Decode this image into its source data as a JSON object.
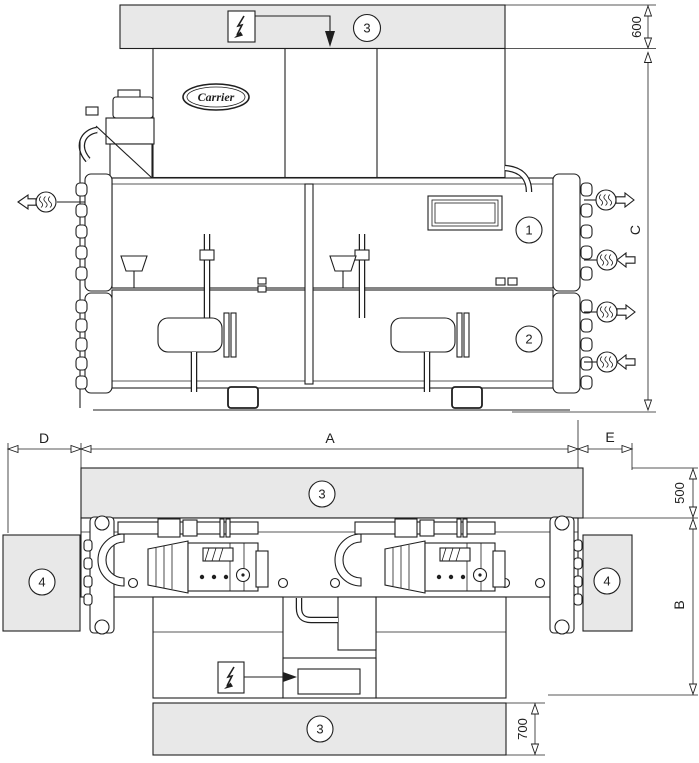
{
  "colors": {
    "zone": "#e8e8e8",
    "line": "#1f1f1f",
    "bg": "#ffffff"
  },
  "brand": {
    "logo": "Carrier"
  },
  "labels": {
    "c1": "1",
    "c2": "2",
    "c3_top": "3",
    "c3_mid": "3",
    "c3_bottom": "3",
    "c4_left": "4",
    "c4_right": "4"
  },
  "dims": {
    "d600": "600",
    "d500": "500",
    "d700": "700",
    "A": "A",
    "B": "B",
    "C": "C",
    "D": "D",
    "E": "E"
  },
  "icons": {
    "electrical": "lightning-bolt",
    "water": "water-flow-arrow"
  }
}
